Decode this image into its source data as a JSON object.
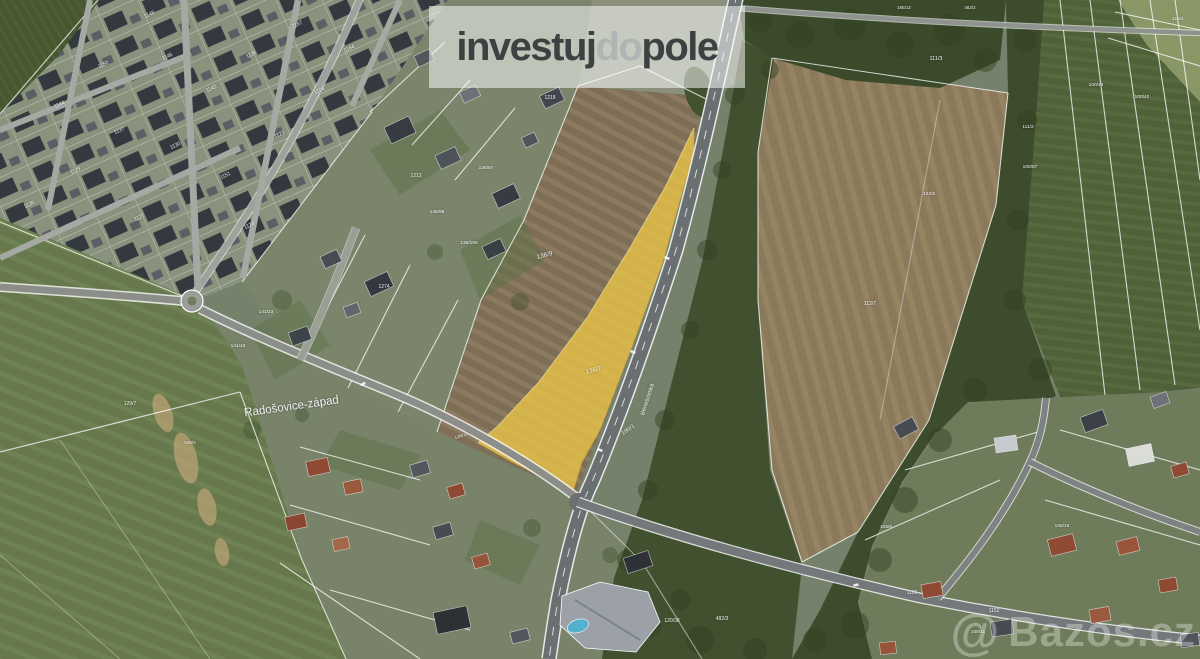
{
  "brand": {
    "part1": "investuj",
    "part2": "do",
    "part3": "pole",
    "band_color": "rgba(255,255,255,0.52)",
    "color_dark": "#3d4141",
    "color_light": "#b0b5b3"
  },
  "photo_credit": {
    "at_symbol": "@",
    "text": "Bazos.cz",
    "color": "rgba(255,255,255,0.32)"
  },
  "map": {
    "area_label": "Radošovice-západ",
    "highlight": {
      "parcel": "136/7",
      "color": "#eac449"
    },
    "road": {
      "name": "Benešovská",
      "parcel": "190/1"
    },
    "labels": [
      {
        "t": "Radošovice-západ",
        "x": 292,
        "y": 410,
        "r": -8,
        "s": 11.5
      },
      {
        "t": "136/9",
        "x": 545,
        "y": 257,
        "r": -15,
        "s": 6.5
      },
      {
        "t": "136/7",
        "x": 594,
        "y": 372,
        "r": -15,
        "s": 6.5
      },
      {
        "t": "190/1",
        "x": 629,
        "y": 431,
        "r": -35,
        "s": 6
      },
      {
        "t": "Benešovská",
        "x": 649,
        "y": 400,
        "r": -72,
        "s": 6
      },
      {
        "t": "1148",
        "x": 150,
        "y": 16,
        "r": -25,
        "s": 5
      },
      {
        "t": "1146",
        "x": 168,
        "y": 58,
        "r": -25,
        "s": 5
      },
      {
        "t": "1150",
        "x": 104,
        "y": 66,
        "r": -25,
        "s": 5
      },
      {
        "t": "1144",
        "x": 60,
        "y": 106,
        "r": -25,
        "s": 5
      },
      {
        "t": "1142",
        "x": 212,
        "y": 90,
        "r": -25,
        "s": 5
      },
      {
        "t": "1136",
        "x": 252,
        "y": 56,
        "r": -25,
        "s": 5
      },
      {
        "t": "1137",
        "x": 120,
        "y": 132,
        "r": -25,
        "s": 5
      },
      {
        "t": "1130",
        "x": 176,
        "y": 147,
        "r": -25,
        "s": 5
      },
      {
        "t": "1129",
        "x": 76,
        "y": 172,
        "r": -25,
        "s": 5
      },
      {
        "t": "1151",
        "x": 226,
        "y": 177,
        "r": -25,
        "s": 5
      },
      {
        "t": "1123",
        "x": 280,
        "y": 136,
        "r": -25,
        "s": 5
      },
      {
        "t": "1135",
        "x": 30,
        "y": 206,
        "r": -25,
        "s": 5
      },
      {
        "t": "1127",
        "x": 140,
        "y": 219,
        "r": -25,
        "s": 5
      },
      {
        "t": "1124",
        "x": 250,
        "y": 227,
        "r": -25,
        "s": 5
      },
      {
        "t": "1104",
        "x": 320,
        "y": 92,
        "r": -25,
        "s": 5
      },
      {
        "t": "1164",
        "x": 350,
        "y": 50,
        "r": -25,
        "s": 5
      },
      {
        "t": "1167",
        "x": 298,
        "y": 26,
        "r": -25,
        "s": 5
      },
      {
        "t": "1213",
        "x": 416,
        "y": 177,
        "r": 0,
        "s": 5
      },
      {
        "t": "1218",
        "x": 550,
        "y": 99,
        "r": 0,
        "s": 5
      },
      {
        "t": "1274",
        "x": 384,
        "y": 288,
        "r": 0,
        "s": 5
      },
      {
        "t": "136/87",
        "x": 486,
        "y": 169,
        "r": 0,
        "s": 4.8
      },
      {
        "t": "136/98",
        "x": 437,
        "y": 213,
        "r": 0,
        "s": 4.8
      },
      {
        "t": "136/159",
        "x": 469,
        "y": 244,
        "r": 0,
        "s": 4.8
      },
      {
        "t": "141/23",
        "x": 266,
        "y": 313,
        "r": 0,
        "s": 4.8
      },
      {
        "t": "141/19",
        "x": 238,
        "y": 347,
        "r": 0,
        "s": 4.8
      },
      {
        "t": "136/14",
        "x": 462,
        "y": 437,
        "r": -18,
        "s": 4.8
      },
      {
        "t": "129/7",
        "x": 130,
        "y": 405,
        "r": 0,
        "s": 5
      },
      {
        "t": "548/3",
        "x": 190,
        "y": 444,
        "r": 0,
        "s": 4.5
      },
      {
        "t": "111/3",
        "x": 936,
        "y": 60,
        "r": 0,
        "s": 5.5
      },
      {
        "t": "100/46",
        "x": 1096,
        "y": 86,
        "r": 0,
        "s": 4.8
      },
      {
        "t": "100/42",
        "x": 1142,
        "y": 98,
        "r": 0,
        "s": 4.8
      },
      {
        "t": "111/2",
        "x": 1028,
        "y": 128,
        "r": 0,
        "s": 4.8
      },
      {
        "t": "122/8",
        "x": 929,
        "y": 195,
        "r": 0,
        "s": 4.8
      },
      {
        "t": "100/87",
        "x": 1030,
        "y": 168,
        "r": 0,
        "s": 4.8
      },
      {
        "t": "115/1",
        "x": 1178,
        "y": 20,
        "r": 0,
        "s": 4.8
      },
      {
        "t": "165/12",
        "x": 904,
        "y": 9,
        "r": 0,
        "s": 4.5
      },
      {
        "t": "462/2",
        "x": 970,
        "y": 9,
        "r": 0,
        "s": 4.5
      },
      {
        "t": "120/38",
        "x": 672,
        "y": 622,
        "r": 0,
        "s": 5
      },
      {
        "t": "482/3",
        "x": 722,
        "y": 620,
        "r": 0,
        "s": 5
      },
      {
        "t": "1152",
        "x": 994,
        "y": 612,
        "r": 0,
        "s": 5
      },
      {
        "t": "1186",
        "x": 912,
        "y": 594,
        "r": 0,
        "s": 5
      },
      {
        "t": "105/6",
        "x": 886,
        "y": 528,
        "r": 0,
        "s": 4.8
      },
      {
        "t": "106/15",
        "x": 1062,
        "y": 527,
        "r": 0,
        "s": 4.8
      },
      {
        "t": "108/11",
        "x": 978,
        "y": 633,
        "r": 0,
        "s": 4.8
      },
      {
        "t": "112/7",
        "x": 870,
        "y": 305,
        "r": 0,
        "s": 5
      }
    ]
  }
}
